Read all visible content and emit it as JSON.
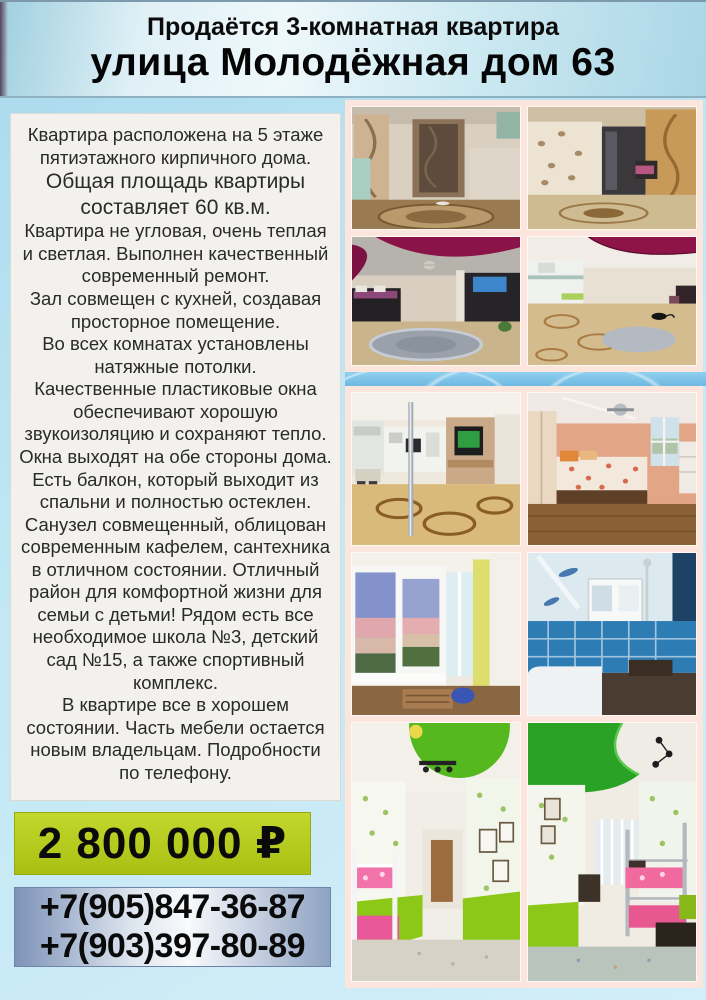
{
  "header": {
    "line1": "Продаётся 3-комнатная квартира",
    "line2": "улица Молодёжная дом 63"
  },
  "description": {
    "paragraphs": [
      "Квартира расположена на 5 этаже пятиэтажного кирпичного дома.",
      "Общая площадь квартиры составляет 60 кв.м.",
      "Квартира не угловая, очень теплая и светлая. Выполнен качественный современный ремонт.",
      "Зал совмещен с кухней, создавая просторное помещение.",
      "Во всех комнатах установлены натяжные потолки.",
      "Качественные пластиковые окна обеспечивают хорошую звукоизоляцию и сохраняют тепло.",
      "Окна выходят на обе стороны дома.",
      "Есть балкон, который выходит из спальни и полностью остеклен.",
      "Санузел совмещенный, облицован современным кафелем, сантехника в отличном состоянии. Отличный район для комфортной жизни для семьи с детьми! Рядом есть все необходимое школа №3, детский сад №15, а также спортивный комплекс.",
      "В квартире все в хорошем состоянии. Часть мебели остается новым владельцам. Подробности по телефону."
    ]
  },
  "price": {
    "amount": "2 800 000 ₽"
  },
  "contacts": {
    "phone1": "+7(905)847-36-87",
    "phone2": "+7(903)397-80-89"
  },
  "photos": [
    "hallway-entrance-photo",
    "corridor-photo",
    "living-room-photo",
    "kitchen-living-room-photo",
    "kitchen-photo",
    "bedroom-photo",
    "balcony-photo",
    "bathroom-photo",
    "kids-room-1-photo",
    "kids-room-2-photo"
  ],
  "colors": {
    "page_bg": "#bfe6f2",
    "header_bg": "#cde9f2",
    "text_panel_bg": "#f2f1ee",
    "price_bg": "#b5cc1e",
    "phone_panel_edge": "#7e93b8",
    "photo_frame": "#fbe5dc",
    "divider_blue": "#7cc4e8"
  }
}
